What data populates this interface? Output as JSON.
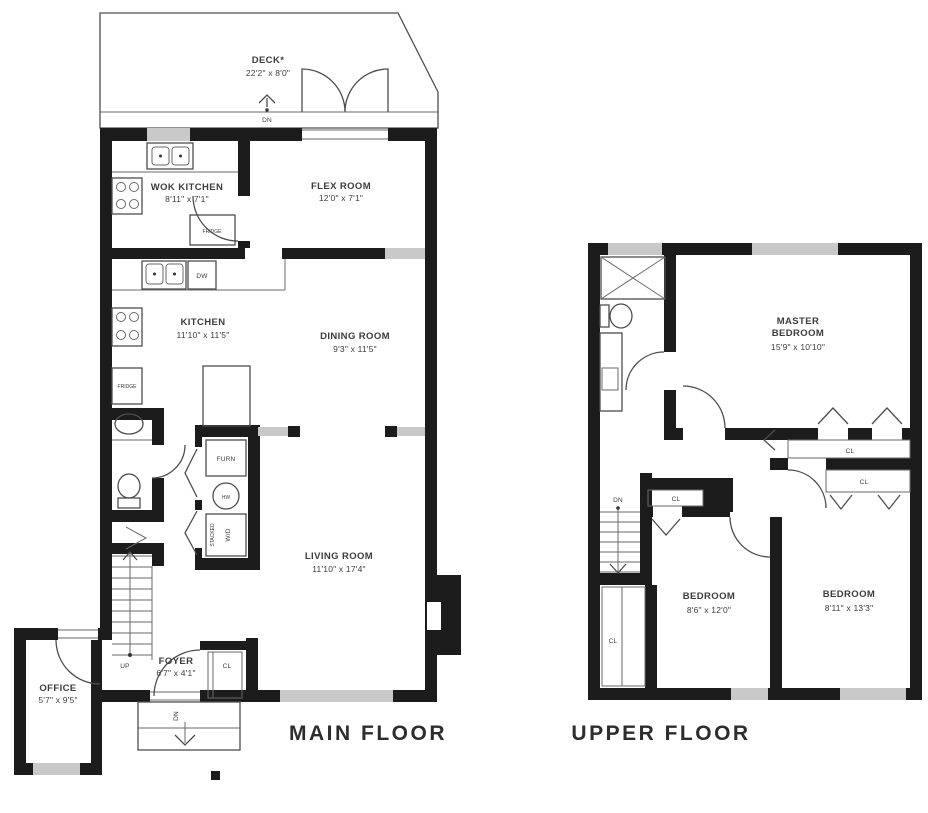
{
  "colors": {
    "wall": "#1c1c1c",
    "window": "#c9c9c9",
    "line": "#4d4d4d",
    "text": "#3d3d3d",
    "title": "#2d2d2d"
  },
  "titles": {
    "main": "MAIN FLOOR",
    "upper": "UPPER FLOOR"
  },
  "main_floor": {
    "deck": {
      "name": "DECK*",
      "dims": "22'2\" x 8'0\""
    },
    "wok_kitchen": {
      "name": "WOK KITCHEN",
      "dims": "8'11\" x 7'1\""
    },
    "flex_room": {
      "name": "FLEX ROOM",
      "dims": "12'0\" x 7'1\""
    },
    "kitchen": {
      "name": "KITCHEN",
      "dims": "11'10\" x 11'5\""
    },
    "dining_room": {
      "name": "DINING ROOM",
      "dims": "9'3\" x 11'5\""
    },
    "living_room": {
      "name": "LIVING ROOM",
      "dims": "11'10\" x 17'4\""
    },
    "foyer": {
      "name": "FOYER",
      "dims": "6'7\" x 4'1\""
    },
    "office": {
      "name": "OFFICE",
      "dims": "5'7\" x 9'5\""
    },
    "fixtures": {
      "fridge_wok": "FRIDGE",
      "fridge_kitchen": "FRIDGE",
      "dishwasher": "DW",
      "furnace": "FURN",
      "hot_water": "HW",
      "washer_dryer": "W/D",
      "stacked": "STACKED",
      "closet": "CL"
    },
    "stairs": {
      "up": "UP",
      "deck_down": "DN",
      "porch_down": "DN"
    }
  },
  "upper_floor": {
    "master_bedroom": {
      "name_line1": "MASTER",
      "name_line2": "BEDROOM",
      "dims": "15'9\" x 10'10\""
    },
    "bedroom_left": {
      "name": "BEDROOM",
      "dims": "8'6\" x 12'0\""
    },
    "bedroom_right": {
      "name": "BEDROOM",
      "dims": "8'11\" x 13'3\""
    },
    "closets": {
      "master": "CL",
      "bedroom_right": "CL",
      "bedroom_left": "CL",
      "hall": "CL"
    },
    "stairs": {
      "down": "DN"
    }
  }
}
